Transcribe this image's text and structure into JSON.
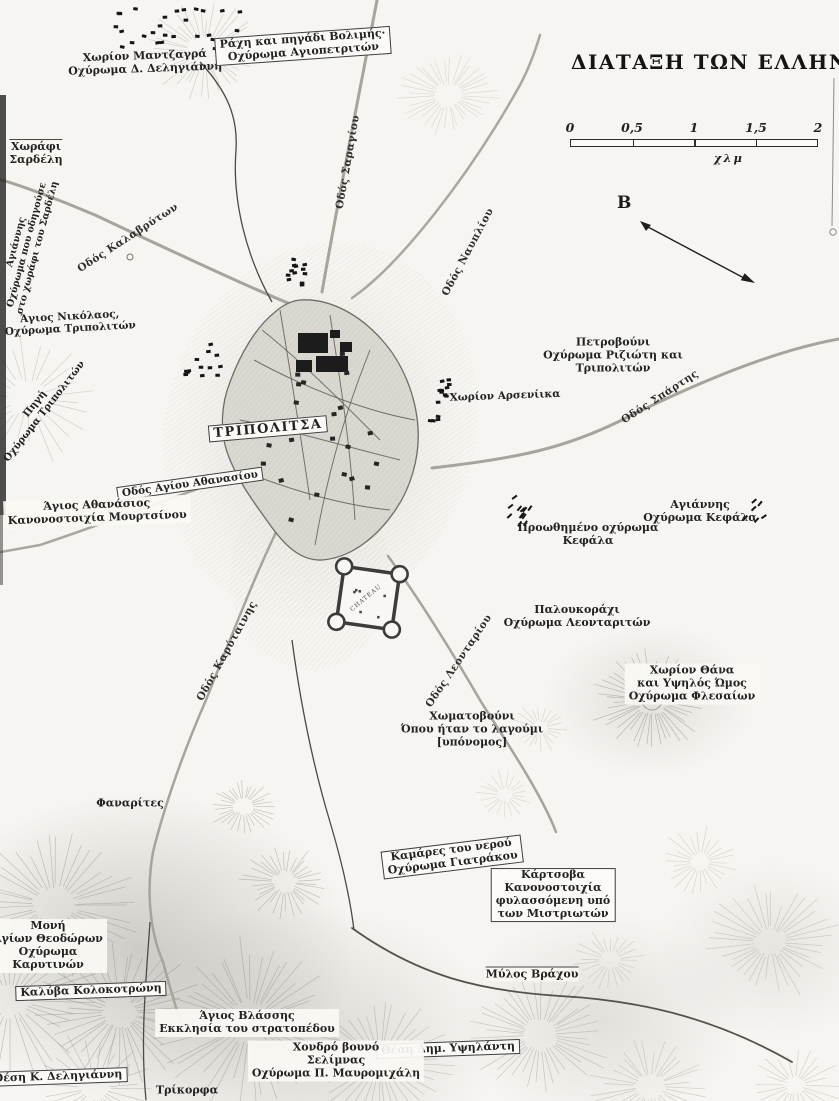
{
  "map": {
    "title": "ΔΙΑΤΑΞΗ ΤΩΝ ΕΛΛΗΝΩΝ",
    "scale_bar": {
      "ticks": [
        "0",
        "0,5",
        "1",
        "1,5",
        "2"
      ],
      "unit": "χλμ"
    },
    "north": {
      "letter": "B"
    },
    "colors": {
      "ink": "#1f1f1f",
      "road": "#a8a49c",
      "dark_line": "#4a4a46",
      "paper": "#f6f5f1"
    },
    "labels": [
      {
        "id": "chorion-mantzagra",
        "lines": [
          "Χωρίον Μαντζαγρά",
          "Οχύρωμα Δ. Δεληγιάννη"
        ],
        "x": 145,
        "y": 63,
        "rot": -2,
        "style": "plain"
      },
      {
        "id": "rachi-volimis",
        "lines": [
          "Ράχη και πηγάδι Βολιμής·",
          "Οχύρωμα Αγιοπετριτών"
        ],
        "x": 303,
        "y": 46,
        "rot": -4,
        "style": "boxed"
      },
      {
        "id": "chorafi-sardeli",
        "lines": [
          "Χωράφι",
          "Σαρδέλη"
        ],
        "x": 36,
        "y": 153,
        "rot": 0,
        "style": "topline"
      },
      {
        "id": "agiannis-sardeli",
        "lines": [
          "Αγιάννης",
          "Οχύρωμα που οδηγούσε",
          "στο χωράφι του Σαρδέλη"
        ],
        "x": 27,
        "y": 245,
        "rot": -75,
        "style": "plain",
        "size": 9.5
      },
      {
        "id": "odos-kalavryton",
        "lines": [
          "Οδός Καλαβρύτων"
        ],
        "x": 128,
        "y": 238,
        "rot": -33,
        "style": "road"
      },
      {
        "id": "agios-nikolaos",
        "lines": [
          "Άγιος Νικόλαος,",
          "Οχύρωμα Τριπολιτών"
        ],
        "x": 70,
        "y": 323,
        "rot": -3,
        "style": "plain",
        "size": 10.5
      },
      {
        "id": "pigi-tripoliton",
        "lines": [
          "Πηγή",
          "Οχύρωμα Τριπολιτών"
        ],
        "x": 40,
        "y": 408,
        "rot": -52,
        "style": "plain",
        "size": 10
      },
      {
        "id": "odos-saragiou",
        "lines": [
          "Οδός Σαραγίου"
        ],
        "x": 348,
        "y": 162,
        "rot": -80,
        "style": "road"
      },
      {
        "id": "odos-nafpliou",
        "lines": [
          "Οδός Ναυπλίου"
        ],
        "x": 468,
        "y": 252,
        "rot": -62,
        "style": "road"
      },
      {
        "id": "petrovouni",
        "lines": [
          "Πετροβούνι",
          "Οχύρωμα Ριζιώτη και",
          "Τριπολιτών"
        ],
        "x": 613,
        "y": 356,
        "rot": 0,
        "style": "plain"
      },
      {
        "id": "odos-spartis",
        "lines": [
          "Οδός Σπάρτης"
        ],
        "x": 660,
        "y": 397,
        "rot": -33,
        "style": "road"
      },
      {
        "id": "chorion-arseniika",
        "lines": [
          "Χωρίον Αρσενίικα"
        ],
        "x": 505,
        "y": 396,
        "rot": -2,
        "style": "plain",
        "size": 10.5
      },
      {
        "id": "tripolitsa",
        "lines": [
          "ΤΡΙΠΟΛΙΤΣΑ"
        ],
        "x": 268,
        "y": 429,
        "rot": -5,
        "style": "boxed",
        "size": 13,
        "ls": 1.5
      },
      {
        "id": "odos-agiou-athanasiou",
        "lines": [
          "Οδός Αγίου Αθανασίου"
        ],
        "x": 190,
        "y": 484,
        "rot": -8,
        "style": "boxed",
        "size": 10.5
      },
      {
        "id": "agios-athanasios",
        "lines": [
          "Άγιος Αθανάσιος",
          "Κανονοστοιχία Μουρτσίνου"
        ],
        "x": 97,
        "y": 512,
        "rot": -2,
        "style": "patch"
      },
      {
        "id": "agiannis-kefala",
        "lines": [
          "Αγιάννης",
          "Οχύρωμα Κεφάλα"
        ],
        "x": 700,
        "y": 512,
        "rot": 0,
        "style": "plain"
      },
      {
        "id": "proothimeno-kefala",
        "lines": [
          "Προωθημένο οχύρωμα",
          "Κεφάλα"
        ],
        "x": 588,
        "y": 535,
        "rot": 0,
        "style": "plain"
      },
      {
        "id": "chateau-fort",
        "lines": [
          "CHATEAU"
        ],
        "x": 366,
        "y": 598,
        "rot": -40,
        "style": "tiny"
      },
      {
        "id": "paloukorachi",
        "lines": [
          "Παλουκοράχι",
          "Οχύρωμα Λεονταριτών"
        ],
        "x": 577,
        "y": 617,
        "rot": 0,
        "style": "plain"
      },
      {
        "id": "odos-leontariou",
        "lines": [
          "Οδός Λεονταρίου"
        ],
        "x": 459,
        "y": 661,
        "rot": -56,
        "style": "road"
      },
      {
        "id": "odos-karytainis",
        "lines": [
          "Οδός Καρύταινης"
        ],
        "x": 227,
        "y": 651,
        "rot": -61,
        "style": "road"
      },
      {
        "id": "chorion-thana",
        "lines": [
          "Χωρίον Θάνα",
          "και Υψηλός Ώμος",
          "Οχύρωμα Φλεσαίων"
        ],
        "x": 692,
        "y": 684,
        "rot": 0,
        "style": "patch"
      },
      {
        "id": "chomatovouni",
        "lines": [
          "Χωματοβούνι",
          "Όπου ήταν το λαγούμι",
          "[υπόνομος]"
        ],
        "x": 472,
        "y": 730,
        "rot": 0,
        "style": "plain"
      },
      {
        "id": "fanarites",
        "lines": [
          "Φαναρίτες"
        ],
        "x": 130,
        "y": 804,
        "rot": 0,
        "style": "plain"
      },
      {
        "id": "kamares-giatrakou",
        "lines": [
          "Καμάρες του νερού",
          "Οχύρωμα Γιατράκου"
        ],
        "x": 452,
        "y": 857,
        "rot": -7,
        "style": "boxed"
      },
      {
        "id": "kartsova",
        "lines": [
          "Κάρτσοβα",
          "Κανονοστοιχία",
          "φυλασσόμενη υπό",
          "των Μιστριωτών"
        ],
        "x": 553,
        "y": 895,
        "rot": 0,
        "style": "boxed"
      },
      {
        "id": "moni-theodoron",
        "lines": [
          "Μονή",
          "Αγίων Θεοδώρων",
          "Οχύρωμα",
          "Καρυτινών"
        ],
        "x": 48,
        "y": 946,
        "rot": 0,
        "style": "patch"
      },
      {
        "id": "kalyva-kolokotroni",
        "lines": [
          "Καλύβα Κολοκοτρώνη"
        ],
        "x": 91,
        "y": 991,
        "rot": -2,
        "style": "boxed"
      },
      {
        "id": "mylos-vrachou",
        "lines": [
          "Μύλος Βράχου"
        ],
        "x": 532,
        "y": 974,
        "rot": 0,
        "style": "topline"
      },
      {
        "id": "agios-vlassis",
        "lines": [
          "Άγιος Βλάσσης",
          "Εκκλησία του στρατοπέδου"
        ],
        "x": 247,
        "y": 1023,
        "rot": 0,
        "style": "patch"
      },
      {
        "id": "thesi-ypsilanti",
        "lines": [
          "Θέση Δημ. Υψηλάντη"
        ],
        "x": 448,
        "y": 1049,
        "rot": -2,
        "style": "boxed"
      },
      {
        "id": "chondro-vouno",
        "lines": [
          "Χονδρό βουνό",
          "Σελίμνας",
          "Οχύρωμα Π. Μαυρομιχάλη"
        ],
        "x": 336,
        "y": 1061,
        "rot": 0,
        "style": "patch"
      },
      {
        "id": "thesi-deligianni",
        "lines": [
          "Θέση Κ. Δεληγιάννη"
        ],
        "x": 58,
        "y": 1077,
        "rot": -2,
        "style": "boxed"
      },
      {
        "id": "trikorfa",
        "lines": [
          "Τρίκορφα"
        ],
        "x": 187,
        "y": 1091,
        "rot": 0,
        "style": "plain"
      }
    ]
  }
}
